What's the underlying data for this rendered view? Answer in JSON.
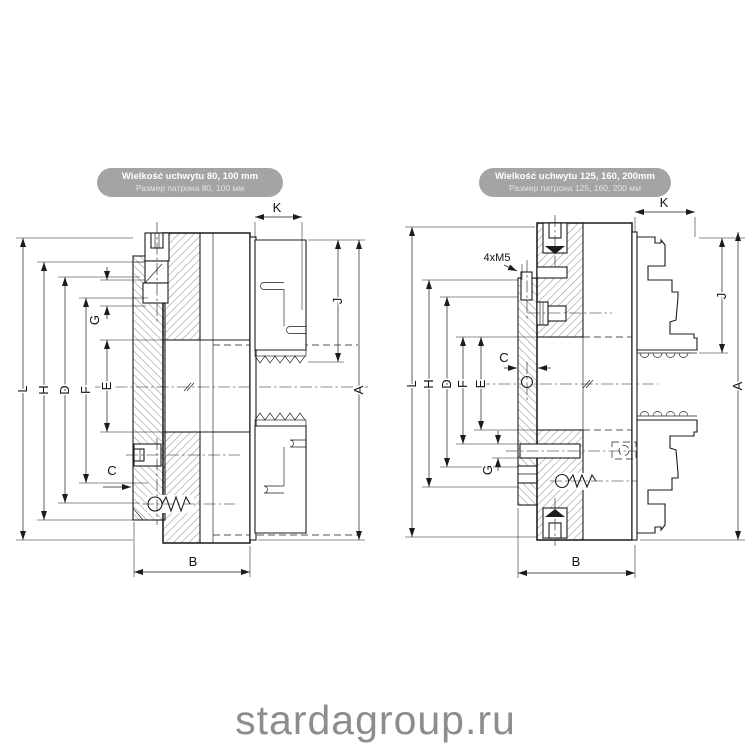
{
  "page": {
    "watermark": "stardagroup.ru",
    "background_color": "#ffffff",
    "line_color": "#1c1c1c",
    "watermark_color": "#8d8d8d",
    "header_pill_color": "#a4a4a4"
  },
  "diagrams": [
    {
      "header": {
        "line1": "Wielkość uchwytu 80, 100 mm",
        "line2": "Размер патрона 80, 100 мм"
      },
      "dim": {
        "L": "L",
        "H": "H",
        "D": "D",
        "F": "F",
        "E": "E",
        "G": "G",
        "C": "C",
        "K": "K",
        "J": "J",
        "A": "A",
        "B": "B"
      }
    },
    {
      "header": {
        "line1": "Wielkość uchwytu 125, 160, 200mm",
        "line2": "Размер патрона 125, 160, 200 мм"
      },
      "note": "4xM5",
      "dim": {
        "L": "L",
        "H": "H",
        "D": "D",
        "F": "F",
        "E": "E",
        "G": "G",
        "C": "C",
        "K": "K",
        "J": "J",
        "A": "A",
        "B": "B"
      }
    }
  ]
}
